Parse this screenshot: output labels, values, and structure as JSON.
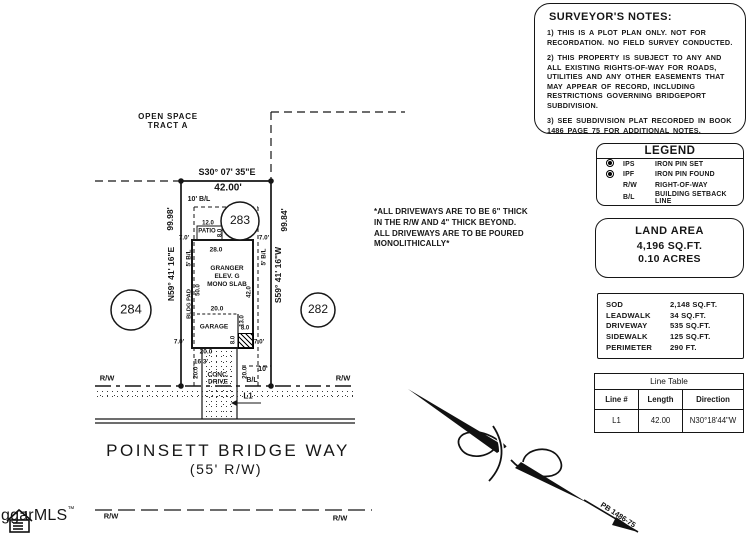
{
  "surveyor_notes": {
    "title": "SURVEYOR'S NOTES:",
    "notes": [
      "1) THIS IS A PLOT PLAN ONLY. NOT FOR RECORDATION. NO FIELD SURVEY CONDUCTED.",
      "2) THIS PROPERTY IS SUBJECT TO ANY AND ALL EXISTING RIGHTS-OF-WAY FOR ROADS, UTILITIES AND ANY OTHER EASEMENTS THAT MAY APPEAR OF RECORD, INCLUDING RESTRICTIONS GOVERNING BRIDGEPORT SUBDIVISION.",
      "3) SEE SUBDIVISION PLAT RECORDED IN BOOK 1486 PAGE 75 FOR ADDITIONAL NOTES."
    ]
  },
  "legend": {
    "title": "LEGEND",
    "items": [
      {
        "symbol": "iron-pin-set-icon",
        "abbr": "IPS",
        "label": "IRON PIN SET"
      },
      {
        "symbol": "iron-pin-found-icon",
        "abbr": "IPF",
        "label": "IRON PIN FOUND"
      },
      {
        "symbol": "",
        "abbr": "R/W",
        "label": "RIGHT-OF-WAY"
      },
      {
        "symbol": "",
        "abbr": "B/L",
        "label": "BUILDING SETBACK LINE"
      }
    ]
  },
  "land_area": {
    "title": "LAND AREA",
    "sqft": "4,196 SQ.FT.",
    "acres": "0.10 ACRES"
  },
  "areas": {
    "rows": [
      {
        "label": "SOD",
        "value": "2,148 SQ.FT."
      },
      {
        "label": "LEADWALK",
        "value": "34 SQ.FT."
      },
      {
        "label": "DRIVEWAY",
        "value": "535 SQ.FT."
      },
      {
        "label": "SIDEWALK",
        "value": "125 SQ.FT."
      },
      {
        "label": "PERIMETER",
        "value": "290 FT."
      }
    ]
  },
  "line_table": {
    "title": "Line Table",
    "headers": [
      "Line #",
      "Length",
      "Direction"
    ],
    "rows": [
      {
        "line": "L1",
        "length": "42.00",
        "direction": "N30°18'44\"W"
      }
    ]
  },
  "driveway_note": "*ALL DRIVEWAYS ARE TO BE 6\" THICK\nIN THE R/W AND 4\" THICK BEYOND.\nALL DRIVEWAYS ARE TO BE POURED\nMONOLITHICALLY*",
  "plot": {
    "open_space": "OPEN SPACE\nTRACT A",
    "bearing_top": "S30° 07' 35\"E",
    "dist_top": "42.00'",
    "bl10_top": "10' B/L",
    "lot283": "283",
    "lot284": "284",
    "lot282": "282",
    "len_left": "99.98'",
    "bearing_left": "N59° 41' 16\"E",
    "len_right": "99.84'",
    "bearing_right": "S59° 41' 16\"W",
    "bl5": "5' B/L",
    "d7": "7.0'",
    "d8": "8.0",
    "d12": "12.0",
    "d13": "13.0",
    "d20": "20.0",
    "d20f": "20.0'",
    "d28": "28.0",
    "d16": "16.3'",
    "d42": "42.0",
    "d50": "50.0",
    "patio": "PATIO",
    "house_name": "GRANGER\nELEV. G\nMONO SLAB",
    "bldg_pad": "BLDG PAD",
    "garage": "GARAGE",
    "drive_label": "CONC.\nDRIVE",
    "bl10_bottom": "10'",
    "bl_bottom": "B/L",
    "rw": "R/W",
    "l1": "L1"
  },
  "street": {
    "name": "POINSETT BRIDGE WAY",
    "rw_width": "(55' R/W)"
  },
  "north_arrow": {
    "label": "PB 1486-75"
  },
  "logo": {
    "text": "ggarMLS",
    "tm": "™"
  },
  "ink_color": "#161616"
}
